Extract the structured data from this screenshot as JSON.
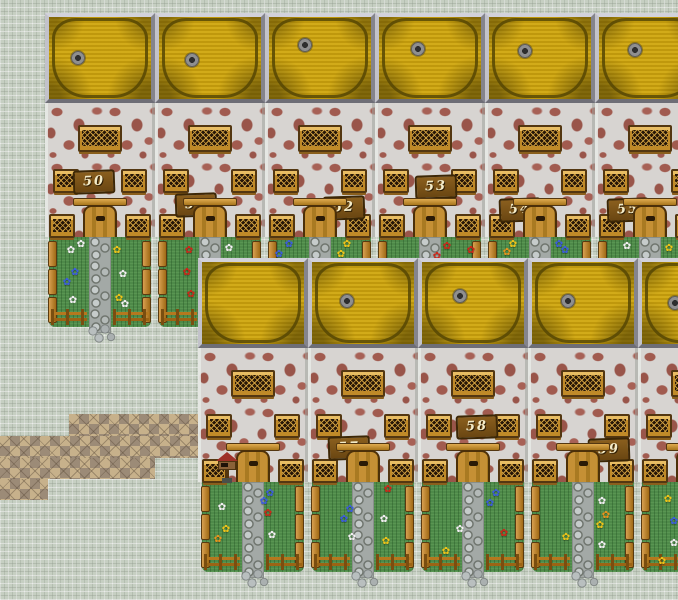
{
  "scene": {
    "description": "tile-based village map with two rows of numbered houses",
    "width": 678,
    "height": 600
  },
  "palette": {
    "roof_gold": "#cda40e",
    "roof_seam": "#5f4e03",
    "frame_gray": "#b7b7bf",
    "wall_base": "#d7d4d1",
    "wall_stone": "#a15b4f",
    "wood_light": "#e8bd63",
    "wood_dark": "#533711",
    "grass_green": "#4e8a49",
    "cobble_gray": "#a3a9a6",
    "ground_tile": "#c6cfc2",
    "dirt_path": "#9c8b77",
    "path_diamond": "#c7b18b",
    "mailbox_roof_red": "#9e3028",
    "flower_white": "#f2f2f2",
    "flower_blue": "#3c5ce0",
    "flower_red": "#cf2518",
    "flower_yellow": "#efc419",
    "flower_orange": "#e8941d"
  },
  "glyphs": {
    "flower": "✿"
  },
  "path_bands": [
    {
      "x": 69,
      "y": 414,
      "w": 134,
      "h": 22
    },
    {
      "x": 0,
      "y": 436,
      "w": 203,
      "h": 22
    },
    {
      "x": 0,
      "y": 458,
      "w": 155,
      "h": 21
    },
    {
      "x": 0,
      "y": 479,
      "w": 48,
      "h": 21
    }
  ],
  "houses": [
    {
      "id": "house-50",
      "number": "50",
      "x": 45,
      "y": 13,
      "row": "top",
      "chimney": {
        "x": 26,
        "y": 38
      },
      "plate": {
        "x": 28,
        "y": 157
      },
      "mailbox": false,
      "flowers": [
        {
          "x": 16,
          "y": 8,
          "c": "white"
        },
        {
          "x": 26,
          "y": 2,
          "c": "white"
        },
        {
          "x": 20,
          "y": 30,
          "c": "blue"
        },
        {
          "x": 12,
          "y": 40,
          "c": "blue"
        },
        {
          "x": 18,
          "y": 58,
          "c": "white"
        },
        {
          "x": 62,
          "y": 8,
          "c": "yellow"
        },
        {
          "x": 68,
          "y": 32,
          "c": "white"
        },
        {
          "x": 64,
          "y": 56,
          "c": "yellow"
        },
        {
          "x": 70,
          "y": 62,
          "c": "white"
        }
      ]
    },
    {
      "id": "house-51",
      "number": "51",
      "x": 155,
      "y": 13,
      "row": "top",
      "chimney": {
        "x": 30,
        "y": 40
      },
      "plate": {
        "x": 20,
        "y": 180
      },
      "mailbox": false,
      "flowers": [
        {
          "x": 24,
          "y": 8,
          "c": "red"
        },
        {
          "x": 22,
          "y": 30,
          "c": "red"
        },
        {
          "x": 26,
          "y": 52,
          "c": "red"
        },
        {
          "x": 64,
          "y": 6,
          "c": "white"
        }
      ]
    },
    {
      "id": "house-52",
      "number": "52",
      "x": 265,
      "y": 13,
      "row": "top",
      "chimney": {
        "x": 33,
        "y": 25
      },
      "plate": {
        "x": 58,
        "y": 183
      },
      "mailbox": false,
      "flowers": [
        {
          "x": 14,
          "y": 2,
          "c": "blue"
        },
        {
          "x": 4,
          "y": 12,
          "c": "blue"
        },
        {
          "x": 72,
          "y": 2,
          "c": "yellow"
        },
        {
          "x": 66,
          "y": 12,
          "c": "yellow"
        }
      ]
    },
    {
      "id": "house-53",
      "number": "53",
      "x": 375,
      "y": 13,
      "row": "top",
      "chimney": {
        "x": 36,
        "y": 29
      },
      "plate": {
        "x": 40,
        "y": 162
      },
      "mailbox": false,
      "flowers": [
        {
          "x": 62,
          "y": 4,
          "c": "red"
        },
        {
          "x": 52,
          "y": 14,
          "c": "red"
        },
        {
          "x": 86,
          "y": 8,
          "c": "red"
        }
      ]
    },
    {
      "id": "house-54",
      "number": "54",
      "x": 485,
      "y": 13,
      "row": "top",
      "chimney": {
        "x": 33,
        "y": 31
      },
      "plate": {
        "x": 14,
        "y": 185
      },
      "mailbox": false,
      "flowers": [
        {
          "x": 18,
          "y": 2,
          "c": "yellow"
        },
        {
          "x": 12,
          "y": 10,
          "c": "orange"
        },
        {
          "x": 64,
          "y": 2,
          "c": "blue"
        },
        {
          "x": 70,
          "y": 8,
          "c": "blue"
        }
      ]
    },
    {
      "id": "house-55",
      "number": "55",
      "x": 595,
      "y": 13,
      "row": "top",
      "chimney": {
        "x": 33,
        "y": 30
      },
      "plate": {
        "x": 12,
        "y": 185
      },
      "mailbox": false,
      "flowers": [
        {
          "x": 22,
          "y": 4,
          "c": "white"
        },
        {
          "x": 64,
          "y": 6,
          "c": "yellow"
        }
      ]
    },
    {
      "id": "house-b1",
      "number": "",
      "x": 198,
      "y": 258,
      "row": "bottom",
      "chimney": null,
      "plate": null,
      "mailbox": true,
      "flowers": [
        {
          "x": 14,
          "y": 20,
          "c": "white"
        },
        {
          "x": 18,
          "y": 42,
          "c": "yellow"
        },
        {
          "x": 10,
          "y": 52,
          "c": "orange"
        },
        {
          "x": 62,
          "y": 6,
          "c": "blue"
        },
        {
          "x": 56,
          "y": 14,
          "c": "blue"
        },
        {
          "x": 60,
          "y": 26,
          "c": "red"
        },
        {
          "x": 64,
          "y": 48,
          "c": "white"
        }
      ]
    },
    {
      "id": "house-57",
      "number": "57",
      "x": 308,
      "y": 258,
      "row": "bottom",
      "chimney": {
        "x": 32,
        "y": 36
      },
      "plate": {
        "x": 20,
        "y": 178
      },
      "mailbox": false,
      "flowers": [
        {
          "x": 70,
          "y": 2,
          "c": "red"
        },
        {
          "x": 32,
          "y": 22,
          "c": "blue"
        },
        {
          "x": 26,
          "y": 32,
          "c": "blue"
        },
        {
          "x": 34,
          "y": 50,
          "c": "white"
        },
        {
          "x": 66,
          "y": 32,
          "c": "white"
        },
        {
          "x": 68,
          "y": 54,
          "c": "yellow"
        }
      ]
    },
    {
      "id": "house-58",
      "number": "58",
      "x": 418,
      "y": 258,
      "row": "bottom",
      "chimney": {
        "x": 35,
        "y": 31
      },
      "plate": {
        "x": 38,
        "y": 157
      },
      "mailbox": false,
      "flowers": [
        {
          "x": 68,
          "y": 6,
          "c": "blue"
        },
        {
          "x": 62,
          "y": 16,
          "c": "blue"
        },
        {
          "x": 32,
          "y": 42,
          "c": "white"
        },
        {
          "x": 76,
          "y": 46,
          "c": "red"
        },
        {
          "x": 18,
          "y": 64,
          "c": "yellow"
        }
      ]
    },
    {
      "id": "house-59",
      "number": "59",
      "x": 528,
      "y": 258,
      "row": "bottom",
      "chimney": {
        "x": 33,
        "y": 36
      },
      "plate": {
        "x": 60,
        "y": 180
      },
      "mailbox": false,
      "flowers": [
        {
          "x": 64,
          "y": 14,
          "c": "white"
        },
        {
          "x": 68,
          "y": 28,
          "c": "orange"
        },
        {
          "x": 62,
          "y": 38,
          "c": "yellow"
        },
        {
          "x": 64,
          "y": 58,
          "c": "white"
        },
        {
          "x": 28,
          "y": 50,
          "c": "yellow"
        }
      ]
    },
    {
      "id": "house-b5",
      "number": "",
      "x": 638,
      "y": 258,
      "row": "bottom",
      "chimney": {
        "x": 30,
        "y": 38
      },
      "plate": null,
      "mailbox": false,
      "flowers": [
        {
          "x": 20,
          "y": 12,
          "c": "yellow"
        },
        {
          "x": 26,
          "y": 34,
          "c": "blue"
        },
        {
          "x": 26,
          "y": 56,
          "c": "white"
        },
        {
          "x": 14,
          "y": 74,
          "c": "yellow"
        }
      ]
    }
  ]
}
